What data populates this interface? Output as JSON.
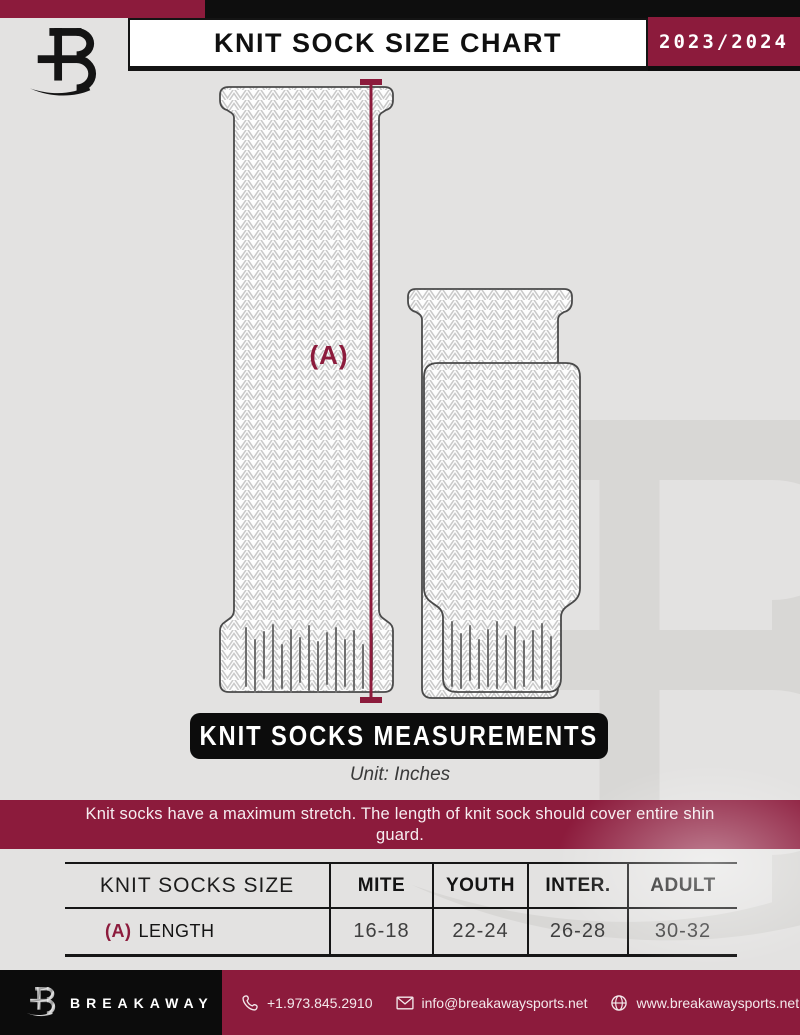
{
  "header": {
    "title": "KNIT SOCK SIZE CHART",
    "season": "2023/2024"
  },
  "diagram": {
    "measure_label": "(A)"
  },
  "section": {
    "banner": "KNIT SOCKS MEASUREMENTS",
    "unit": "Unit: Inches",
    "note": "Knit socks have a maximum stretch. The length of knit sock should cover entire shin guard."
  },
  "size_table": {
    "columns": [
      "KNIT SOCKS SIZE",
      "MITE",
      "YOUTH",
      "INTER.",
      "ADULT"
    ],
    "row": {
      "key": "(A)",
      "label": "LENGTH",
      "values": [
        "16-18",
        "22-24",
        "26-28",
        "30-32"
      ]
    }
  },
  "footer": {
    "brand": "BREAKAWAY",
    "phone": "+1.973.845.2910",
    "email": "info@breakawaysports.net",
    "website": "www.breakawaysports.net"
  },
  "colors": {
    "maroon": "#8C1B3C",
    "black": "#0E0E0E",
    "background": "#E3E2E1",
    "watermark": "#D8D7D5"
  },
  "icons": {
    "brand_logo": "breakaway-b-monogram",
    "phone": "phone-icon",
    "email": "envelope-icon",
    "website": "globe-icon"
  }
}
